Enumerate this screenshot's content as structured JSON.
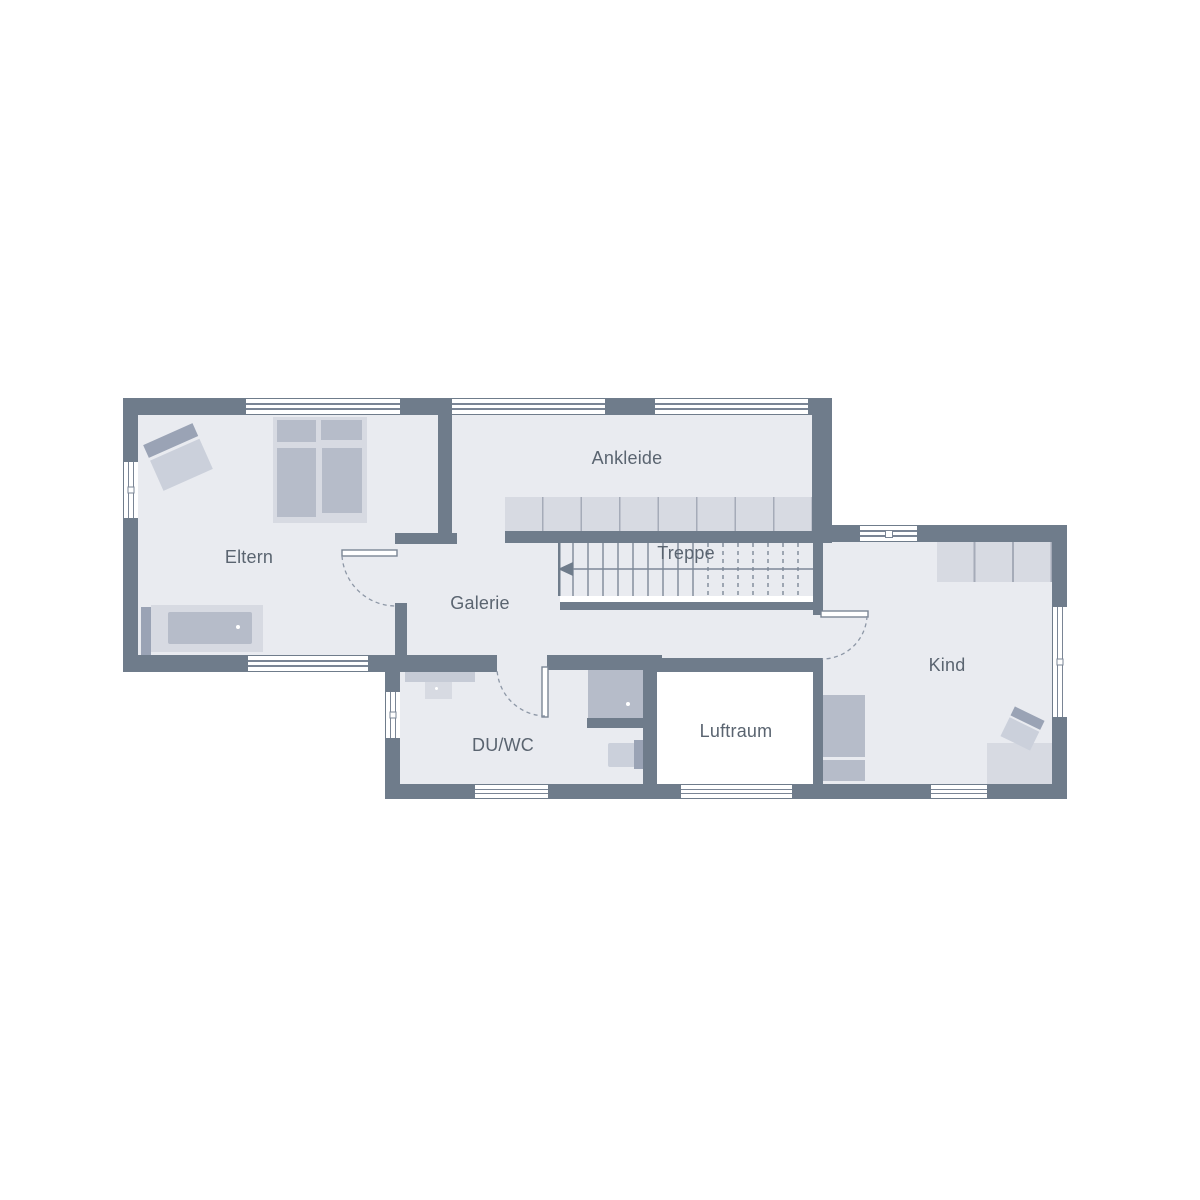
{
  "plan": {
    "type": "floor-plan",
    "floor_name": "Obergeschoss (upper floor)",
    "language": "de"
  },
  "palette": {
    "wall": "#6f7c8b",
    "floor": "#e9ebf0",
    "furnLight": "#d7dae2",
    "furnMid": "#b6bcc9",
    "furnDark": "#9aa3b5",
    "furnPale": "#cbd0db",
    "shelf": "#c6cbd6",
    "cellLine": "#a5abb8",
    "winLine": "#7a8595",
    "tread": "#7d8897",
    "arc": "#8d97a6",
    "text": "#5a6470",
    "white": "#ffffff"
  },
  "rooms": {
    "eltern": {
      "label": "Eltern"
    },
    "ankleide": {
      "label": "Ankleide"
    },
    "treppe": {
      "label": "Treppe"
    },
    "galerie": {
      "label": "Galerie"
    },
    "duwc": {
      "label": "DU/WC"
    },
    "luftraum": {
      "label": "Luftraum"
    },
    "kind": {
      "label": "Kind"
    }
  }
}
